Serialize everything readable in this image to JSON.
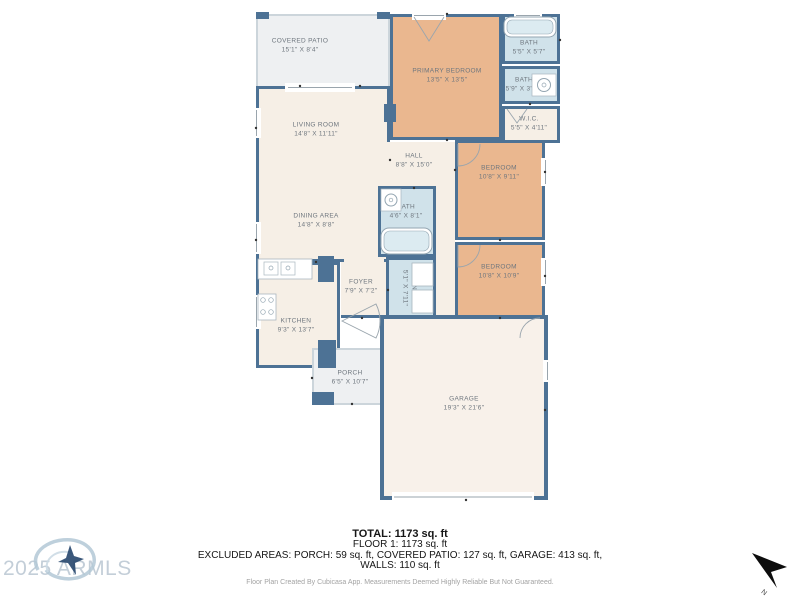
{
  "colors": {
    "wall": "#4d7295",
    "bedroom_fill": "#eab78f",
    "bath_fill": "#d0e2ea",
    "floor_fill": "#f6efe6",
    "outdoor_fill": "#eef0f2",
    "garage_fill": "#f8f1ea",
    "label_text": "#6e767e",
    "watermark": "#c3ced8"
  },
  "rooms": {
    "covered_patio": {
      "name": "COVERED PATIO",
      "dims": "15'1\" X 8'4\""
    },
    "living": {
      "name": "LIVING ROOM",
      "dims": "14'8\" X 11'11\""
    },
    "dining": {
      "name": "DINING AREA",
      "dims": "14'8\" X 8'8\""
    },
    "primary_bedroom": {
      "name": "PRIMARY BEDROOM",
      "dims": "13'5\" X 13'5\""
    },
    "bath_primary": {
      "name": "BATH",
      "dims": "5'5\" X 5'7\""
    },
    "bath_small": {
      "name": "BATH",
      "dims": "5'9\" X 3'10\""
    },
    "wic": {
      "name": "W.I.C.",
      "dims": "5'5\" X 4'11\""
    },
    "hall": {
      "name": "HALL",
      "dims": "8'8\" X 15'0\""
    },
    "bath_hall": {
      "name": "BATH",
      "dims": "4'6\" X 8'1\""
    },
    "bedroom_2": {
      "name": "BEDROOM",
      "dims": "10'8\" X 9'11\""
    },
    "bedroom_3": {
      "name": "BEDROOM",
      "dims": "10'8\" X 10'9\""
    },
    "kitchen": {
      "name": "KITCHEN",
      "dims": "9'3\" X 13'7\""
    },
    "foyer": {
      "name": "FOYER",
      "dims": "7'9\" X 7'2\""
    },
    "laundry": {
      "name": "LAUNDRY",
      "dims": "5'1\" X 7'11\""
    },
    "porch": {
      "name": "PORCH",
      "dims": "6'5\" X 10'7\""
    },
    "garage": {
      "name": "GARAGE",
      "dims": "19'3\" X 21'6\""
    }
  },
  "summary": {
    "total": "TOTAL: 1173 sq. ft",
    "floor1": "FLOOR 1: 1173 sq. ft",
    "excluded_line1": "EXCLUDED AREAS: PORCH: 59 sq. ft, COVERED PATIO: 127 sq. ft, GARAGE: 413 sq. ft,",
    "excluded_line2": "WALLS: 110 sq. ft",
    "disclaimer": "Floor Plan Created By Cubicasa App. Measurements Deemed Highly Reliable But Not Guaranteed."
  },
  "watermark": {
    "text": "2025 ARMLS"
  },
  "compass": {
    "label": "N"
  }
}
